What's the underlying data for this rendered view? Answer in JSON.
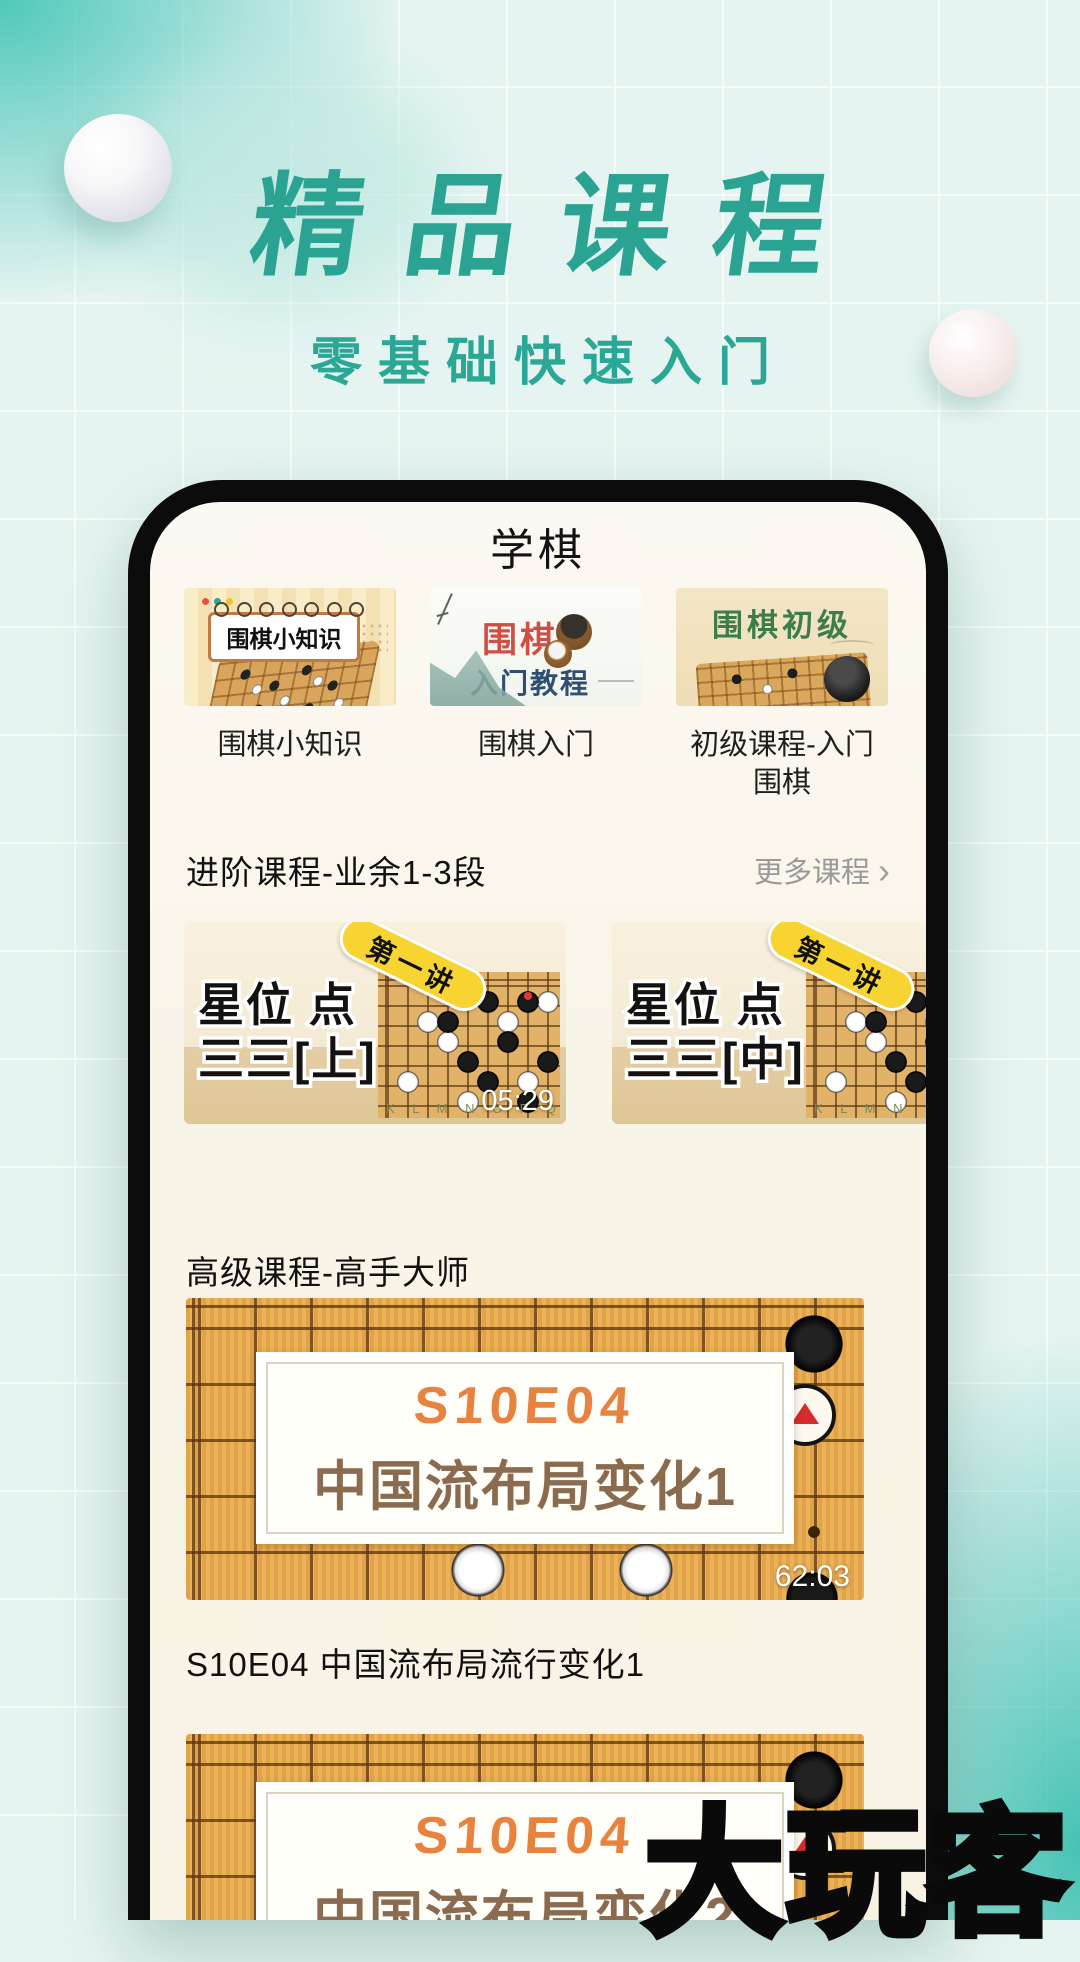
{
  "hero": {
    "title": "精品课程",
    "subtitle": "零基础快速入门"
  },
  "app": {
    "header_title": "学棋",
    "courses": [
      {
        "label": "围棋小知识",
        "thumb": {
          "banner": "围棋小知识"
        }
      },
      {
        "label": "围棋入门",
        "thumb": {
          "title": "围棋",
          "subtitle": "入门教程"
        }
      },
      {
        "label": "初级课程-入门围棋",
        "thumb": {
          "title": "围棋初级"
        }
      }
    ],
    "section_intermediate": {
      "title": "进阶课程-业余1-3段",
      "more_label": "更多课程",
      "chevron": "›",
      "videos": [
        {
          "badge": "第一讲",
          "title_line1": "星位 点",
          "title_line2": "三三[上]",
          "duration": "05:29",
          "board_letters": "K L M N O P Q R S"
        },
        {
          "badge": "第一讲",
          "title_line1": "星位 点",
          "title_line2": "三三[中]",
          "board_letters": "K L M N"
        }
      ]
    },
    "section_advanced": {
      "title": "高级课程-高手大师",
      "caption": "S10E04 中国流布局流行变化1",
      "videos": [
        {
          "banner_top": "S10E04",
          "banner_bottom": "中国流布局变化1",
          "duration": "62:03"
        },
        {
          "banner_top": "S10E04",
          "banner_bottom": "中国流布局变化2"
        }
      ]
    }
  },
  "watermark": "大玩客",
  "colors": {
    "accent_teal": "#2aa392",
    "board_tan": "#e9ab4e",
    "banner_orange": "#e8823f",
    "banner_brown": "#8a6b4f",
    "ribbon_yellow": "#f7d431",
    "duration_text": "#ffffff"
  }
}
